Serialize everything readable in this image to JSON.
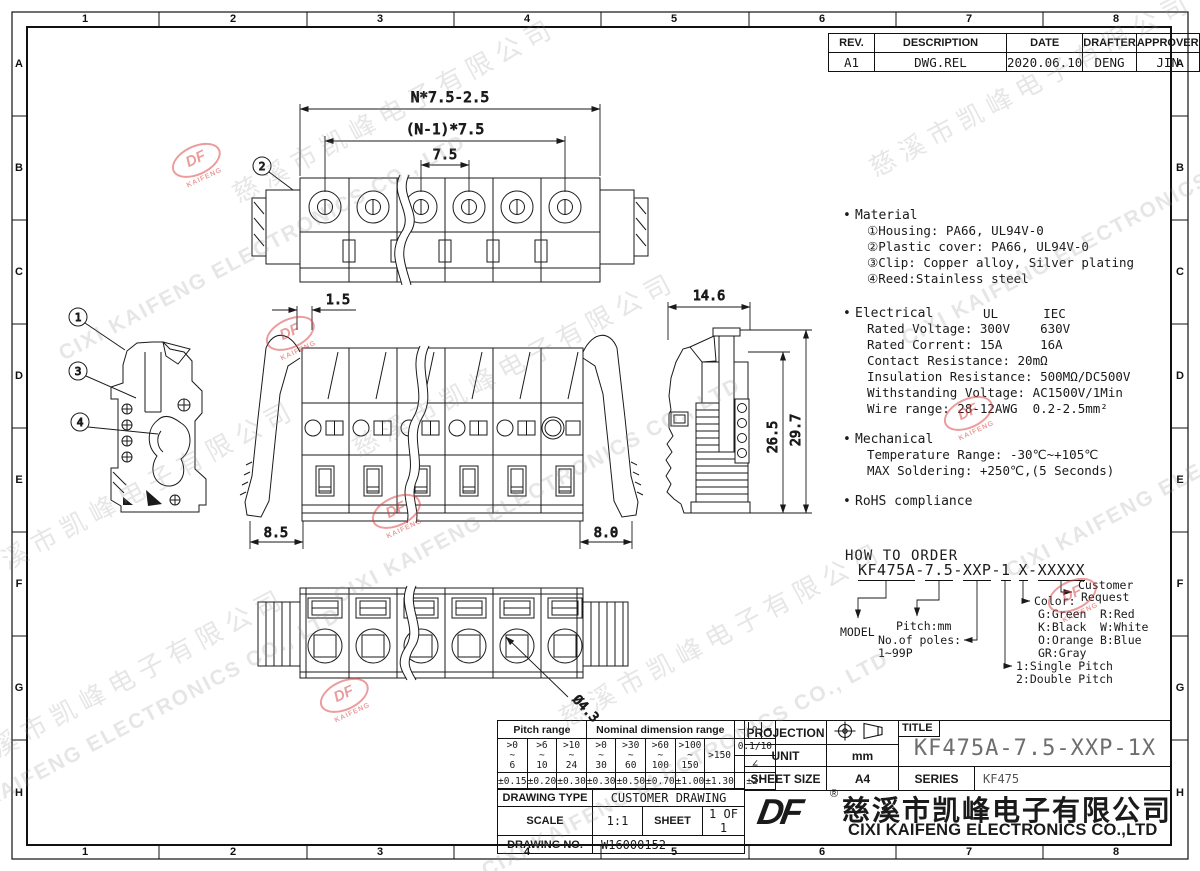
{
  "frame": {
    "columns": [
      "1",
      "2",
      "3",
      "4",
      "5",
      "6",
      "7",
      "8"
    ],
    "rows": [
      "A",
      "B",
      "C",
      "D",
      "E",
      "F",
      "G",
      "H"
    ]
  },
  "watermark": {
    "cn": "慈溪市凯峰电子有限公司",
    "en": "CIXI KAIFENG ELECTRONICS CO., LTD",
    "logo_top": "DF",
    "logo_bottom": "KAIFENG"
  },
  "revision": {
    "headers": {
      "rev": "REV.",
      "description": "DESCRIPTION",
      "date": "DATE",
      "drafter": "DRAFTER",
      "approver": "APPROVER"
    },
    "entry": {
      "rev": "A1",
      "description": "DWG.REL",
      "date": "2020.06.10",
      "drafter": "DENG",
      "approver": "JIN"
    }
  },
  "dims": {
    "overall": "N*7.5-2.5",
    "pitch_n": "(N-1)*7.5",
    "pitch": "7.5",
    "offset": "1.5",
    "left_width": "8.5",
    "right_width": "8.0",
    "side_depth": "14.6",
    "height_inner": "26.5",
    "height_total": "29.7",
    "hole_dia": "Ø4.3"
  },
  "balloons": {
    "b1": "1",
    "b2": "2",
    "b3": "3",
    "b4": "4"
  },
  "notes": {
    "material": {
      "title": "Material",
      "lines": [
        "①Housing: PA66, UL94V-0",
        "②Plastic cover: PA66, UL94V-0",
        "③Clip: Copper alloy, Silver plating",
        "④Reed:Stainless steel"
      ]
    },
    "electrical": {
      "title": "Electrical",
      "col_ul": "UL",
      "col_iec": "IEC",
      "lines": [
        "Rated Voltage: 300V    630V",
        "Rated Corrent: 15A     16A",
        "Contact Resistance: 20mΩ",
        "Insulation Resistance: 500MΩ/DC500V",
        "Withstanding Voltage: AC1500V/1Min",
        "Wire range: 28-12AWG  0.2-2.5mm²"
      ]
    },
    "mechanical": {
      "title": "Mechanical",
      "lines": [
        "Temperature Range: -30℃~+105℃",
        "MAX Soldering: +250℃,(5 Seconds)"
      ]
    },
    "rohs": {
      "title": "RoHS compliance"
    }
  },
  "order": {
    "title": "HOW TO ORDER",
    "segments": {
      "model": "KF475A",
      "sep1": "-",
      "pitch": "7.5",
      "sep2": "-",
      "poles": "XXP",
      "sep3": "-",
      "pitch_type": "1",
      "color": "X",
      "sep4": "-",
      "custom": "XXXXX"
    },
    "labels": {
      "model": "MODEL",
      "pitch": "Pitch:mm",
      "poles1": "No.of poles:",
      "poles2": "1~99P",
      "type1": "1:Single Pitch",
      "type2": "2:Double Pitch",
      "color": "Color:",
      "customer1": "Customer",
      "customer2": "Request"
    },
    "colors": {
      "c1": "G:Green",
      "c2": "K:Black",
      "c3": "O:Orange",
      "c4": "GR:Gray",
      "c5": "R:Red",
      "c6": "W:White",
      "c7": "B:Blue"
    }
  },
  "tolerance": {
    "pitch_header": "Pitch range",
    "nominal_header": "Nominal dimension range",
    "cells": [
      {
        "a": ">0",
        "m": "~",
        "b": "6"
      },
      {
        "a": ">6",
        "m": "~",
        "b": "10"
      },
      {
        "a": ">10",
        "m": "~",
        "b": "24"
      },
      {
        "a": ">0",
        "m": "~",
        "b": "30"
      },
      {
        "a": ">30",
        "m": "~",
        "b": "60"
      },
      {
        "a": ">60",
        "m": "~",
        "b": "100"
      },
      {
        "a": ">100",
        "m": "~",
        "b": "150"
      }
    ],
    "last_range": ">150",
    "tols": [
      "±0.15",
      "±0.20",
      "±0.30",
      "±0.30",
      "±0.50",
      "±0.70",
      "±1.00",
      "±1.30"
    ],
    "sym_straight": "—",
    "sym_arc": "∩",
    "sym_flat": "▱",
    "flat_tol": "0.1/10",
    "sym_angle": "∠",
    "angle_tol": "±2°"
  },
  "info": {
    "type_label": "DRAWING TYPE",
    "type_value": "CUSTOMER DRAWING",
    "scale_label": "SCALE",
    "scale_value": "1:1",
    "sheet_label": "SHEET",
    "sheet_value": "1 OF 1",
    "no_label": "DRAWING NO.",
    "no_value": "W16000152"
  },
  "titleblock": {
    "projection_label": "PROJECTION",
    "unit_label": "UNIT",
    "unit_value": "mm",
    "sheet_size_label": "SHEET SIZE",
    "sheet_size_value": "A4",
    "title_label": "TITLE",
    "title_value": "KF475A-7.5-XXP-1X",
    "series_label": "SERIES",
    "series_value": "KF475"
  },
  "company": {
    "logo": "DF",
    "reg": "®",
    "cn": "慈溪市凯峰电子有限公司",
    "en": "CIXI KAIFENG ELECTRONICS CO.,LTD"
  }
}
